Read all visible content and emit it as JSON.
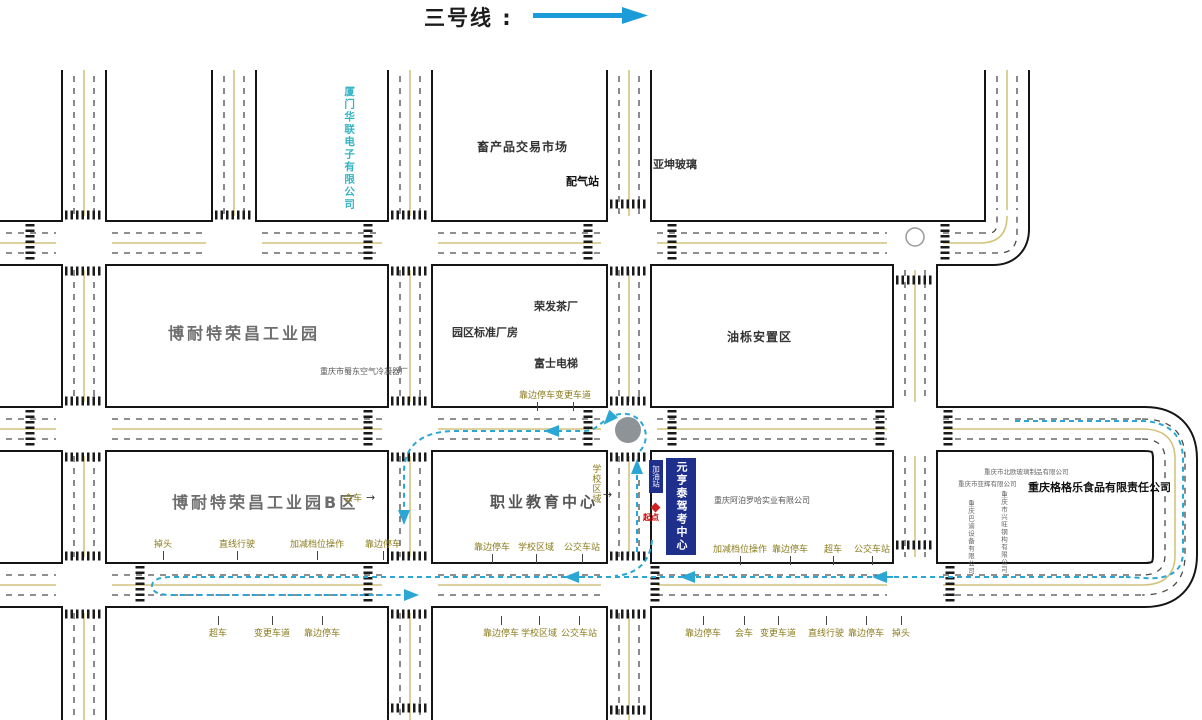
{
  "title": {
    "line_label": "三号线 :"
  },
  "map": {
    "route_color": "#2aa7d4",
    "road_border_color": "#151515",
    "lane_yellow": "#d2c47e",
    "icons": {
      "east_arrow": "→"
    },
    "start": {
      "label": "起点"
    },
    "facilities": {
      "gas_station": "加油站",
      "test_center": "元亨泰驾考中心"
    },
    "places": [
      {
        "name": "xiamen-hualian-electronics-label",
        "text": "厦门华联电子有限公司",
        "x": 343,
        "y": 86,
        "cls": "v-cyan"
      },
      {
        "name": "livestock-market-label",
        "text": "畜产品交易市场",
        "x": 477,
        "y": 141,
        "cls": "p12"
      },
      {
        "name": "gas-distribution-station-label",
        "text": "配气站",
        "x": 566,
        "y": 176,
        "cls": "p11b"
      },
      {
        "name": "yakun-glass-label",
        "text": "亚坤玻璃",
        "x": 653,
        "y": 159,
        "cls": "p11"
      },
      {
        "name": "bonaite-industrial-park-label",
        "text": "博耐特荣昌工业园",
        "x": 168,
        "y": 325,
        "cls": "big"
      },
      {
        "name": "air-condenser-factory-label",
        "text": "重庆市蜀东空气冷凝器厂",
        "x": 320,
        "y": 367,
        "cls": "tiny"
      },
      {
        "name": "rongfa-tea-factory-label",
        "text": "荣发茶厂",
        "x": 534,
        "y": 301,
        "cls": "p11"
      },
      {
        "name": "park-standard-workshop-label",
        "text": "园区标准厂房",
        "x": 452,
        "y": 327,
        "cls": "p11"
      },
      {
        "name": "fuji-elevator-label",
        "text": "富士电梯",
        "x": 534,
        "y": 358,
        "cls": "p11"
      },
      {
        "name": "youli-resettlement-area-label",
        "text": "油栎安置区",
        "x": 727,
        "y": 331,
        "cls": "p12"
      },
      {
        "name": "bonaite-industrial-park-b-label",
        "text": "博耐特荣昌工业园B区",
        "x": 172,
        "y": 494,
        "cls": "big"
      },
      {
        "name": "vocational-education-center-label",
        "text": "职业教育中心",
        "x": 490,
        "y": 494,
        "cls": "big2"
      },
      {
        "name": "apoluoha-company-label",
        "text": "重庆阿泊罗哈实业有限公司",
        "x": 714,
        "y": 496,
        "cls": "tiny"
      },
      {
        "name": "glass-company-label",
        "text": "重庆市北欧玻璃制品有限公司",
        "x": 984,
        "y": 469,
        "cls": "tiny7"
      },
      {
        "name": "small-company-label",
        "text": "重庆市亚辉有限公司",
        "x": 958,
        "y": 481,
        "cls": "tiny7"
      },
      {
        "name": "gegele-food-company-label",
        "text": "重庆格格乐食品有限责任公司",
        "x": 1028,
        "y": 482,
        "cls": "p11b"
      },
      {
        "name": "vertical-company-1-label",
        "text": "重庆市兴旺钢构有限公司",
        "x": 999,
        "y": 491,
        "cls": "tiny7v"
      },
      {
        "name": "vertical-company-2-label",
        "text": "重庆巴渝设备有限公司",
        "x": 966,
        "y": 500,
        "cls": "tiny7v"
      },
      {
        "name": "school-zone-side-label",
        "text": "学校区域",
        "x": 590,
        "y": 464,
        "cls": "olive-v"
      },
      {
        "name": "meeting-vehicles-side-label",
        "text": "会车",
        "x": 344,
        "y": 494,
        "cls": "olive"
      },
      {
        "name": "meeting-arrow-icon",
        "text": "→",
        "x": 366,
        "y": 492,
        "cls": "arrow-glyph"
      },
      {
        "name": "school-zone-arrow-icon",
        "text": "→",
        "x": 603,
        "y": 489,
        "cls": "arrow-glyph"
      }
    ],
    "exam_labels": [
      {
        "text": "掉头",
        "x": 163,
        "y": 537,
        "tick": "down"
      },
      {
        "text": "直线行驶",
        "x": 237,
        "y": 537,
        "tick": "down"
      },
      {
        "text": "加减档位操作",
        "x": 317,
        "y": 537,
        "tick": "down"
      },
      {
        "text": "靠边停车",
        "x": 383,
        "y": 537,
        "tick": "down"
      },
      {
        "text": "靠边停车",
        "x": 492,
        "y": 540,
        "tick": "down"
      },
      {
        "text": "学校区域",
        "x": 536,
        "y": 540,
        "tick": "down"
      },
      {
        "text": "公交车站",
        "x": 582,
        "y": 540,
        "tick": "down"
      },
      {
        "text": "加减档位操作",
        "x": 740,
        "y": 542,
        "tick": "down"
      },
      {
        "text": "靠边停车",
        "x": 790,
        "y": 542,
        "tick": "down"
      },
      {
        "text": "超车",
        "x": 833,
        "y": 542,
        "tick": "down"
      },
      {
        "text": "公交车站",
        "x": 872,
        "y": 542,
        "tick": "down"
      },
      {
        "text": "超车",
        "x": 218,
        "y": 616,
        "tick": "up"
      },
      {
        "text": "变更车道",
        "x": 272,
        "y": 616,
        "tick": "up"
      },
      {
        "text": "靠边停车",
        "x": 322,
        "y": 616,
        "tick": "up"
      },
      {
        "text": "靠边停车",
        "x": 501,
        "y": 616,
        "tick": "up"
      },
      {
        "text": "学校区域",
        "x": 539,
        "y": 616,
        "tick": "up"
      },
      {
        "text": "公交车站",
        "x": 579,
        "y": 616,
        "tick": "up"
      },
      {
        "text": "靠边停车",
        "x": 703,
        "y": 616,
        "tick": "up"
      },
      {
        "text": "会车",
        "x": 744,
        "y": 616,
        "tick": "up"
      },
      {
        "text": "变更车道",
        "x": 778,
        "y": 616,
        "tick": "up"
      },
      {
        "text": "直线行驶",
        "x": 826,
        "y": 616,
        "tick": "up"
      },
      {
        "text": "靠边停车",
        "x": 866,
        "y": 616,
        "tick": "up"
      },
      {
        "text": "掉头",
        "x": 901,
        "y": 616,
        "tick": "up"
      },
      {
        "text": "靠边停车",
        "x": 537,
        "y": 388,
        "tick": "down"
      },
      {
        "text": "变更车道",
        "x": 573,
        "y": 388,
        "tick": "down"
      }
    ]
  }
}
